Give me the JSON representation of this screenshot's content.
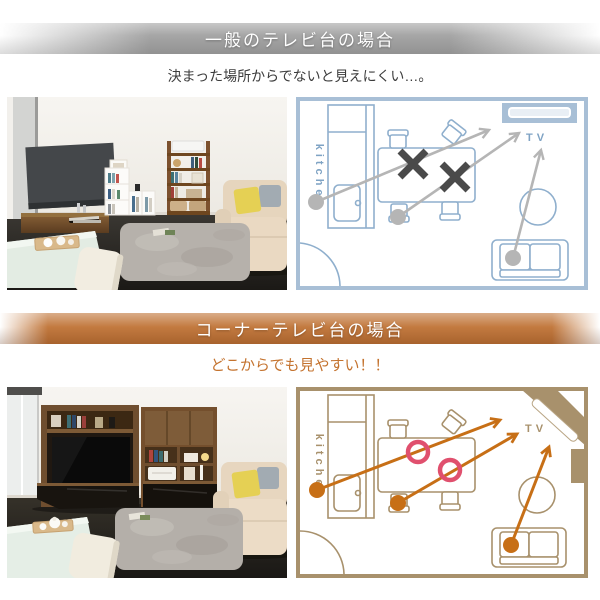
{
  "colors": {
    "banner-gray": "#a6a6a6",
    "banner-orange": "#c1763a",
    "subtitle1": "#3c3c3c",
    "subtitle2": "#c4732f",
    "plan-blue-wall": "#a8bfd6",
    "plan-blue-line": "#8fafcd",
    "plan-blue-text": "#7fa3c4",
    "plan-gray-arrow": "#b5b5b5",
    "plan-x-mark": "#4a4a4a",
    "plan-tan": "#a8916c",
    "plan-orange-arrow": "#c76f16",
    "plan-ring": "#e0506e"
  },
  "section_general": {
    "header": "一般のテレビ台の場合",
    "subtitle": "決まった場所からでないと見えにくい…。",
    "plan": {
      "kitchen_label": "kitchen",
      "tv_label": "TV"
    }
  },
  "section_corner": {
    "header": "コーナーテレビ台の場合",
    "subtitle": "どこからでも見やすい！！",
    "plan": {
      "kitchen_label": "kitchen",
      "tv_label": "TV"
    }
  }
}
